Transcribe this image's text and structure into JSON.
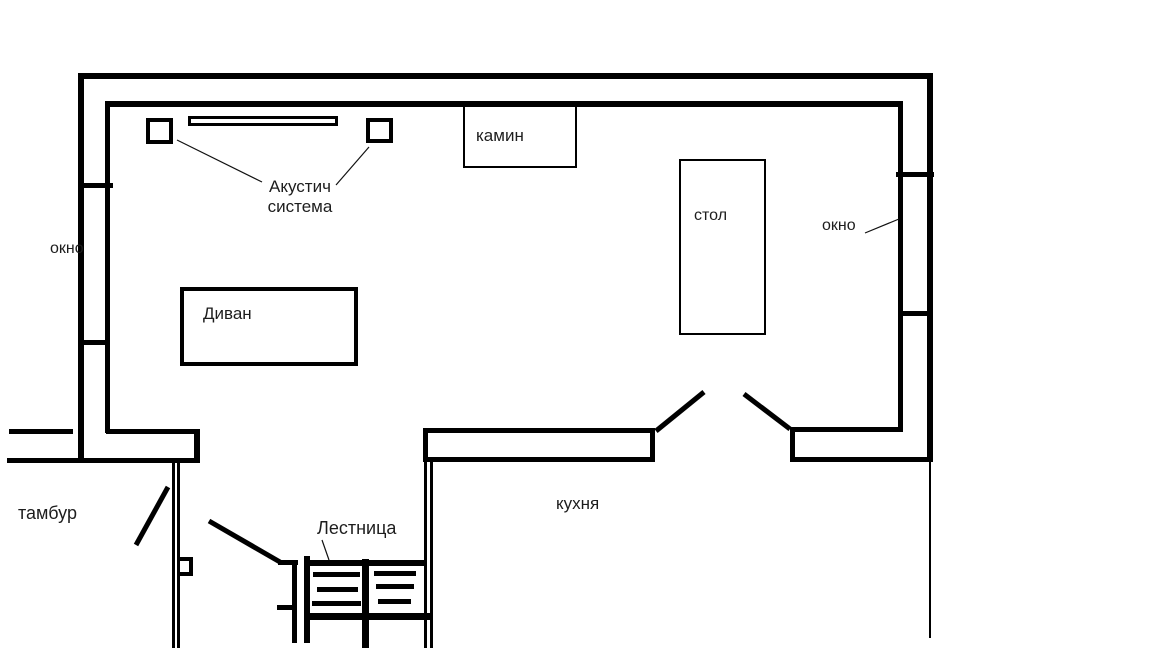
{
  "title": "План помещения (рисованная схема)",
  "labels": {
    "acoustic_line1": "Акустич",
    "acoustic_line2": "система",
    "fireplace": "камин",
    "table": "стол",
    "window_left": "окно",
    "window_right": "окно",
    "sofa": "Диван",
    "vestibule": "тамбур",
    "staircase": "Лестница",
    "kitchen": "кухня"
  },
  "icons": {
    "speaker_left": "speaker-square",
    "speaker_right": "speaker-square",
    "tv_shelf": "long-shelf-bar",
    "door_swing": "diagonal-door-line",
    "stairs": "stair-treads"
  },
  "colors": {
    "wall": "#000000",
    "text": "#1d1d1d",
    "background": "#ffffff"
  }
}
